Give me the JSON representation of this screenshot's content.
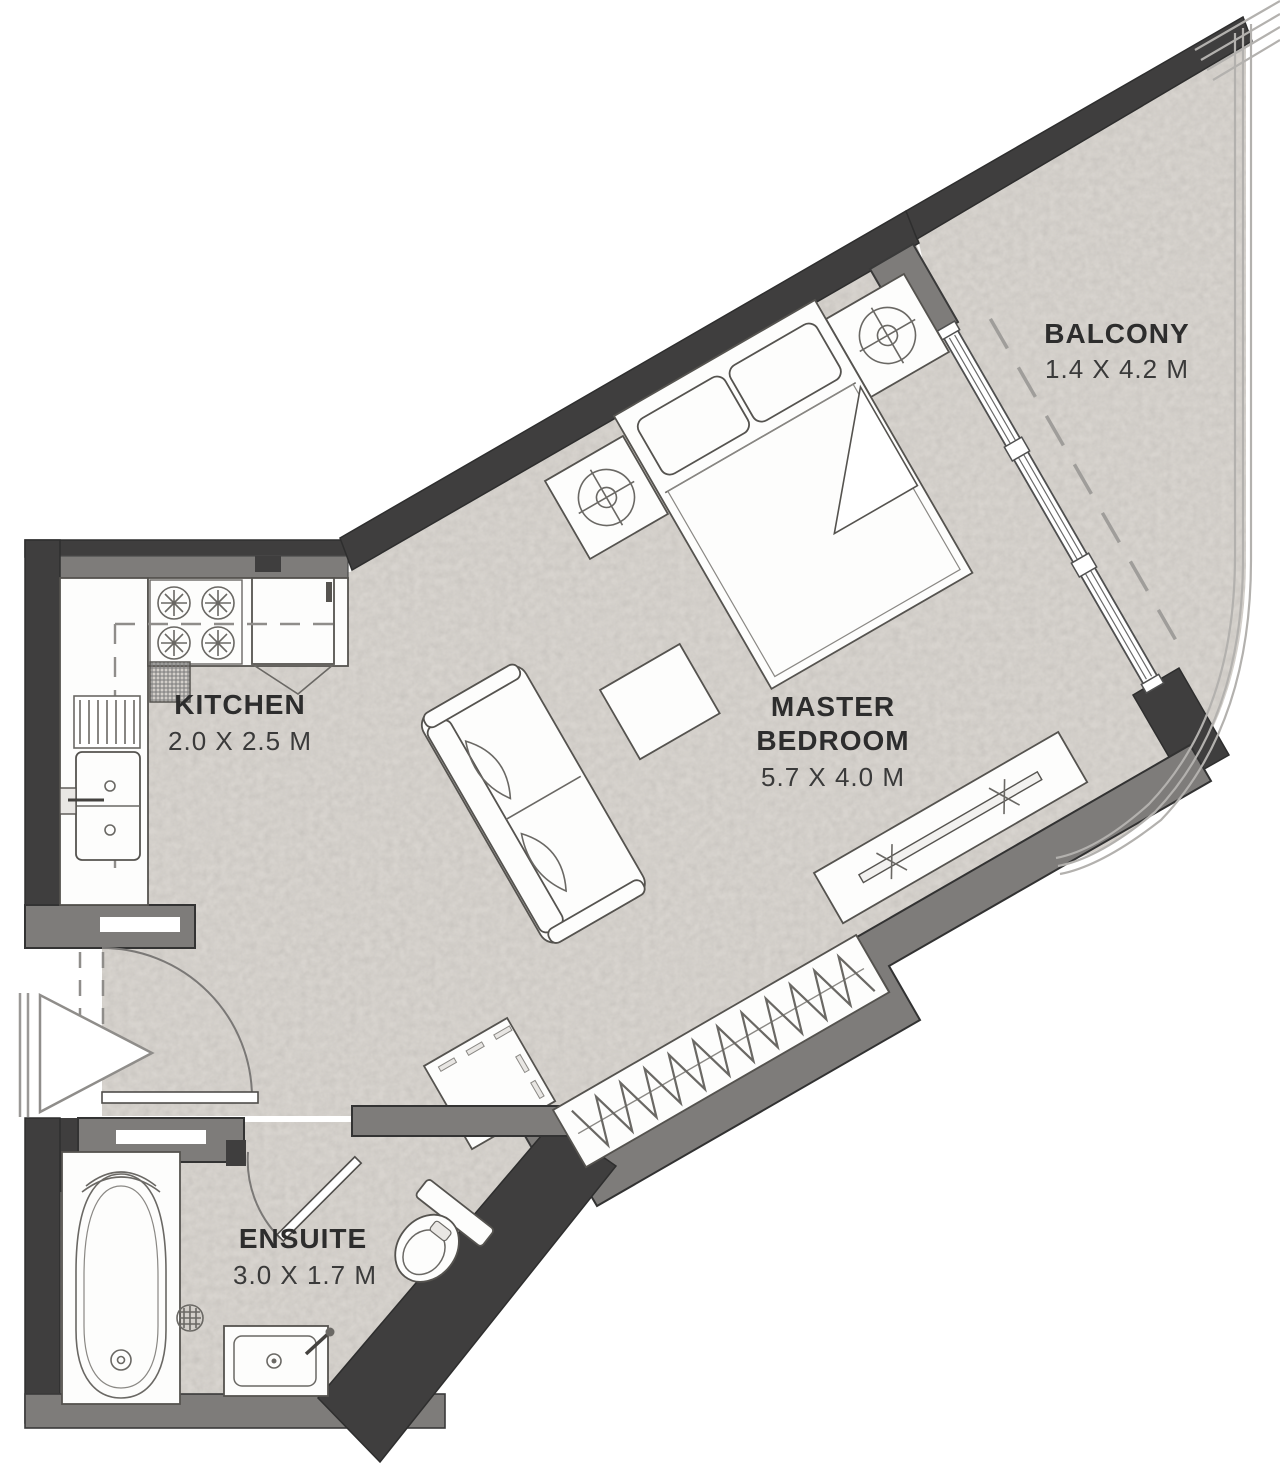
{
  "plan": {
    "type": "apartment-floor-plan",
    "rooms": {
      "kitchen": {
        "name": "KITCHEN",
        "dims": "2.0 X 2.5 M"
      },
      "master_bedroom": {
        "name_line1": "MASTER",
        "name_line2": "BEDROOM",
        "dims": "5.7 X 4.0 M"
      },
      "ensuite": {
        "name": "ENSUITE",
        "dims": "3.0 X 1.7 M"
      },
      "balcony": {
        "name": "BALCONY",
        "dims": "1.4 X 4.2 M"
      }
    },
    "fixtures": [
      "gas-hob",
      "refrigerator",
      "kitchen-sink",
      "drain-board",
      "double-bed",
      "pillows",
      "bedside-table",
      "ceiling-light",
      "sofa",
      "coffee-table",
      "tv-console",
      "wardrobe-hangers",
      "washing-machine",
      "bathtub",
      "toilet",
      "vanity-sink",
      "floor-drain",
      "entry-arrow",
      "entry-door-swing",
      "ensuite-door-swing",
      "sliding-glass-door",
      "balcony-railing"
    ]
  },
  "colors": {
    "background": "#ffffff",
    "floor": "#d8d4cf",
    "wall_dark": "#3f3e3e",
    "wall_mid": "#7e7c7a",
    "slot_white": "#ffffff",
    "railing": "#b3b1ae",
    "label": "#2d2d2d"
  }
}
